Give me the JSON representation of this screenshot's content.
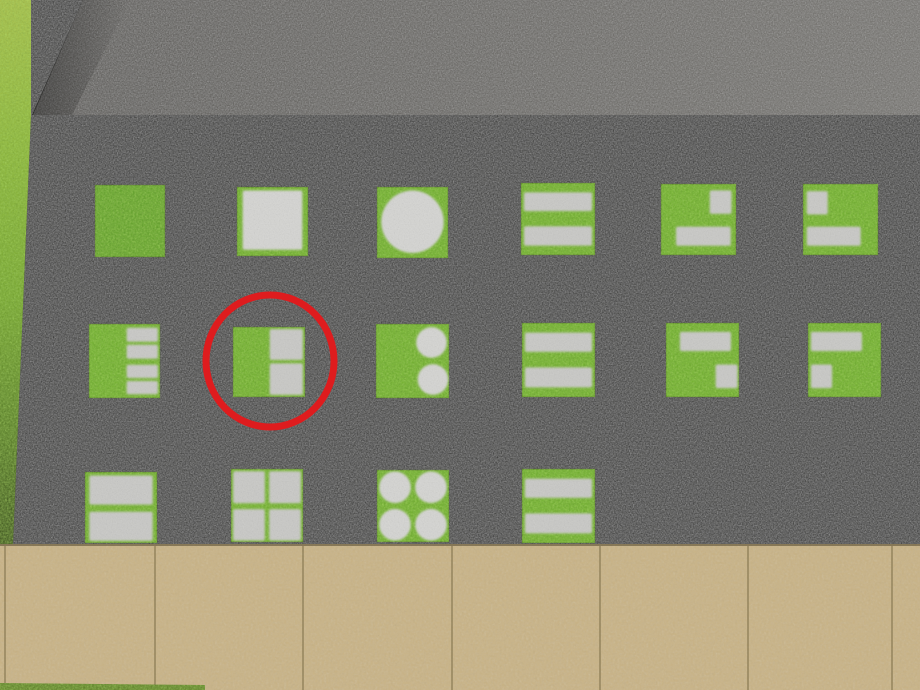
{
  "scene": {
    "viewport": {
      "width": 920,
      "height": 690
    },
    "colors": {
      "asphalt": "#2d2d2b",
      "concrete_band_left": "#54524e",
      "concrete_band_right": "#6e6c67",
      "grass_tile": "#6fae2c",
      "grass_tile_dark": "#61a128",
      "stone": "#c9c9c6",
      "stone_light": "#d6d6d3",
      "sidewalk": "#c9b385",
      "sidewalk_seam": "#82734c",
      "sidewalk_top_edge": "rgba(70,60,35,0.5)",
      "bottom_grass_edge": "#5e7d26",
      "annotation_red": "#de1c1e"
    },
    "grass_strip_stops": [
      [
        "0",
        "#aabf4e"
      ],
      [
        "0.28",
        "#8db53a"
      ],
      [
        "0.55",
        "#75a42d"
      ],
      [
        "0.80",
        "#527523"
      ],
      [
        "1",
        "#2c3a13"
      ]
    ],
    "regions": {
      "concrete_band": {
        "points": "83,0 920,0 920,115 33,115"
      },
      "concrete_band_shade": {
        "points": "83,0 130,0 72,115 33,115"
      },
      "asphalt": {
        "points": "31,0 83,0 32,115 920,115 920,544 13,544 31,115"
      },
      "grass_strip": {
        "points": "0,0 31,0 31,115 13,544 0,544"
      },
      "sidewalk": {
        "x": 0,
        "y": 544,
        "width": 920,
        "height": 146
      },
      "bottom_grass_edge": {
        "points": "0,683 205,685 205,690 0,690"
      },
      "sidewalk_seams_x": [
        5,
        155,
        303,
        452,
        600,
        748,
        892
      ]
    },
    "board": {
      "tiles": [
        {
          "row": 1,
          "col": 1,
          "x": 95,
          "y": 185,
          "w": 70,
          "h": 72,
          "pattern": "plain",
          "shade": "dark",
          "highlighted": false
        },
        {
          "row": 1,
          "col": 2,
          "x": 237,
          "y": 187,
          "w": 71,
          "h": 69,
          "pattern": "big-square",
          "highlighted": false
        },
        {
          "row": 1,
          "col": 3,
          "x": 377,
          "y": 187,
          "w": 71,
          "h": 71,
          "pattern": "big-circle",
          "highlighted": false
        },
        {
          "row": 1,
          "col": 4,
          "x": 521,
          "y": 183,
          "w": 74,
          "h": 72,
          "pattern": "two-bars",
          "highlighted": false
        },
        {
          "row": 1,
          "col": 5,
          "x": 661,
          "y": 184,
          "w": 75,
          "h": 71,
          "pattern": "square-tr-bar-bottom",
          "highlighted": false
        },
        {
          "row": 1,
          "col": 6,
          "x": 803,
          "y": 184,
          "w": 75,
          "h": 71,
          "pattern": "square-tl-bar-bottom",
          "highlighted": false
        },
        {
          "row": 2,
          "col": 1,
          "x": 89,
          "y": 324,
          "w": 71,
          "h": 74,
          "pattern": "four-bars-right",
          "highlighted": false
        },
        {
          "row": 2,
          "col": 2,
          "x": 233,
          "y": 327,
          "w": 72,
          "h": 70,
          "pattern": "two-squares-right",
          "highlighted": true
        },
        {
          "row": 2,
          "col": 3,
          "x": 376,
          "y": 324,
          "w": 73,
          "h": 74,
          "pattern": "two-circles-right",
          "highlighted": false
        },
        {
          "row": 2,
          "col": 4,
          "x": 522,
          "y": 323,
          "w": 73,
          "h": 74,
          "pattern": "two-bars",
          "highlighted": false
        },
        {
          "row": 2,
          "col": 5,
          "x": 666,
          "y": 323,
          "w": 73,
          "h": 74,
          "pattern": "bar-top-square-br",
          "highlighted": false
        },
        {
          "row": 2,
          "col": 6,
          "x": 808,
          "y": 323,
          "w": 73,
          "h": 74,
          "pattern": "bar-top-square-bl",
          "highlighted": false
        },
        {
          "row": 3,
          "col": 1,
          "x": 85,
          "y": 472,
          "w": 72,
          "h": 71,
          "pattern": "two-big-bars",
          "highlighted": false
        },
        {
          "row": 3,
          "col": 2,
          "x": 231,
          "y": 469,
          "w": 72,
          "h": 73,
          "pattern": "four-squares",
          "highlighted": false
        },
        {
          "row": 3,
          "col": 3,
          "x": 377,
          "y": 470,
          "w": 72,
          "h": 72,
          "pattern": "four-circles",
          "highlighted": false
        },
        {
          "row": 3,
          "col": 4,
          "x": 522,
          "y": 469,
          "w": 73,
          "h": 74,
          "pattern": "two-bars",
          "highlighted": false
        }
      ]
    },
    "patterns": {
      "plain": [],
      "big-square": [
        {
          "t": "r",
          "x": 0.08,
          "y": 0.05,
          "w": 0.84,
          "h": 0.86,
          "light": true
        }
      ],
      "big-circle": [
        {
          "t": "c",
          "x": 0.5,
          "y": 0.49,
          "r": 0.44
        }
      ],
      "two-bars": [
        {
          "t": "r",
          "x": 0.04,
          "y": 0.13,
          "w": 0.92,
          "h": 0.26
        },
        {
          "t": "r",
          "x": 0.04,
          "y": 0.6,
          "w": 0.92,
          "h": 0.27
        }
      ],
      "square-tr-bar-bottom": [
        {
          "t": "r",
          "x": 0.65,
          "y": 0.09,
          "w": 0.29,
          "h": 0.33
        },
        {
          "t": "r",
          "x": 0.2,
          "y": 0.6,
          "w": 0.73,
          "h": 0.27
        }
      ],
      "square-tl-bar-bottom": [
        {
          "t": "r",
          "x": 0.05,
          "y": 0.1,
          "w": 0.28,
          "h": 0.33
        },
        {
          "t": "r",
          "x": 0.05,
          "y": 0.6,
          "w": 0.72,
          "h": 0.27
        }
      ],
      "four-bars-right": [
        {
          "t": "r",
          "x": 0.53,
          "y": 0.05,
          "w": 0.44,
          "h": 0.19
        },
        {
          "t": "r",
          "x": 0.53,
          "y": 0.28,
          "w": 0.44,
          "h": 0.19
        },
        {
          "t": "r",
          "x": 0.53,
          "y": 0.55,
          "w": 0.44,
          "h": 0.18
        },
        {
          "t": "r",
          "x": 0.53,
          "y": 0.77,
          "w": 0.44,
          "h": 0.18
        }
      ],
      "two-squares-right": [
        {
          "t": "r",
          "x": 0.51,
          "y": 0.03,
          "w": 0.46,
          "h": 0.44
        },
        {
          "t": "r",
          "x": 0.51,
          "y": 0.52,
          "w": 0.46,
          "h": 0.45
        }
      ],
      "two-circles-right": [
        {
          "t": "c",
          "x": 0.76,
          "y": 0.25,
          "r": 0.21
        },
        {
          "t": "c",
          "x": 0.78,
          "y": 0.75,
          "r": 0.21
        }
      ],
      "bar-top-square-br": [
        {
          "t": "r",
          "x": 0.19,
          "y": 0.12,
          "w": 0.7,
          "h": 0.26
        },
        {
          "t": "r",
          "x": 0.68,
          "y": 0.56,
          "w": 0.3,
          "h": 0.32
        }
      ],
      "bar-top-square-bl": [
        {
          "t": "r",
          "x": 0.04,
          "y": 0.12,
          "w": 0.7,
          "h": 0.26
        },
        {
          "t": "r",
          "x": 0.04,
          "y": 0.56,
          "w": 0.29,
          "h": 0.32
        }
      ],
      "two-big-bars": [
        {
          "t": "r",
          "x": 0.06,
          "y": 0.05,
          "w": 0.88,
          "h": 0.41
        },
        {
          "t": "r",
          "x": 0.06,
          "y": 0.56,
          "w": 0.88,
          "h": 0.41
        }
      ],
      "four-squares": [
        {
          "t": "r",
          "x": 0.03,
          "y": 0.03,
          "w": 0.44,
          "h": 0.44
        },
        {
          "t": "r",
          "x": 0.53,
          "y": 0.03,
          "w": 0.44,
          "h": 0.44
        },
        {
          "t": "r",
          "x": 0.03,
          "y": 0.55,
          "w": 0.44,
          "h": 0.43
        },
        {
          "t": "r",
          "x": 0.53,
          "y": 0.55,
          "w": 0.44,
          "h": 0.43
        }
      ],
      "four-circles": [
        {
          "t": "c",
          "x": 0.25,
          "y": 0.24,
          "r": 0.22
        },
        {
          "t": "c",
          "x": 0.75,
          "y": 0.24,
          "r": 0.22
        },
        {
          "t": "c",
          "x": 0.25,
          "y": 0.76,
          "r": 0.22
        },
        {
          "t": "c",
          "x": 0.75,
          "y": 0.76,
          "r": 0.22
        }
      ]
    }
  },
  "annotation": {
    "type": "ellipse",
    "cx": 270,
    "cy": 361,
    "rx": 64,
    "ry": 66,
    "stroke_width": 7
  }
}
